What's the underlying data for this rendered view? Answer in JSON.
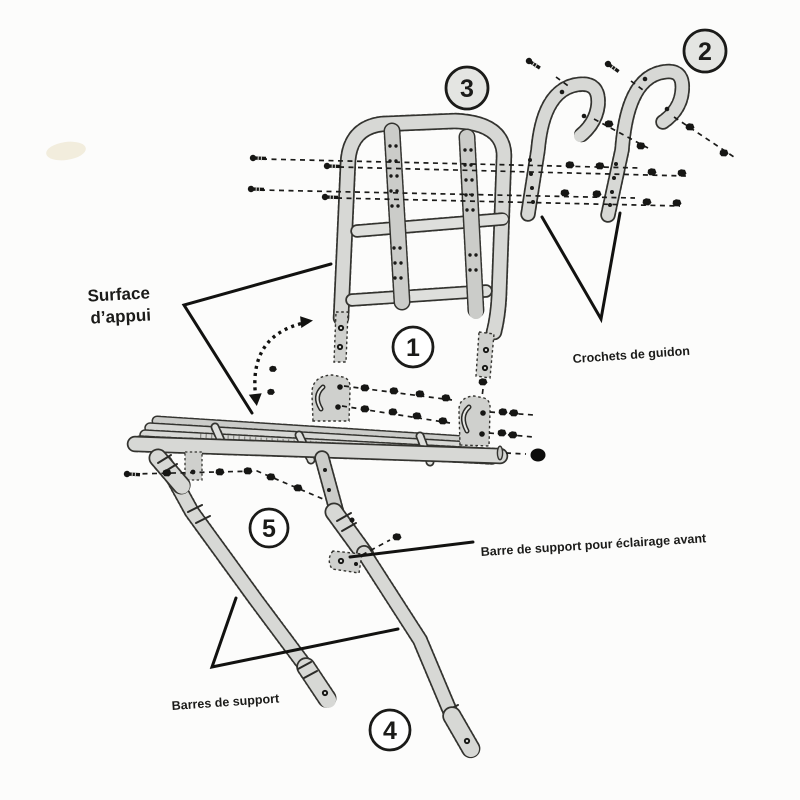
{
  "figure": {
    "subject": "Vue éclatée d'un porte-bagages avant de vélo",
    "background": "#fcfcfb",
    "ink": "#1b1b19",
    "metal": "#d7d8d5",
    "circle_fill_gray": "#e4e5e2",
    "circle_fill_white": "#ffffff",
    "part_numbers": [
      "1",
      "2",
      "3",
      "4",
      "5"
    ],
    "callouts": {
      "surface": {
        "line1": "Surface",
        "line2": "d’appui"
      },
      "crochets": {
        "text": "Crochets de guidon"
      },
      "barre_eclairage": {
        "text": "Barre de support pour éclairage avant"
      },
      "barres_support": {
        "text": "Barres de support"
      }
    }
  }
}
